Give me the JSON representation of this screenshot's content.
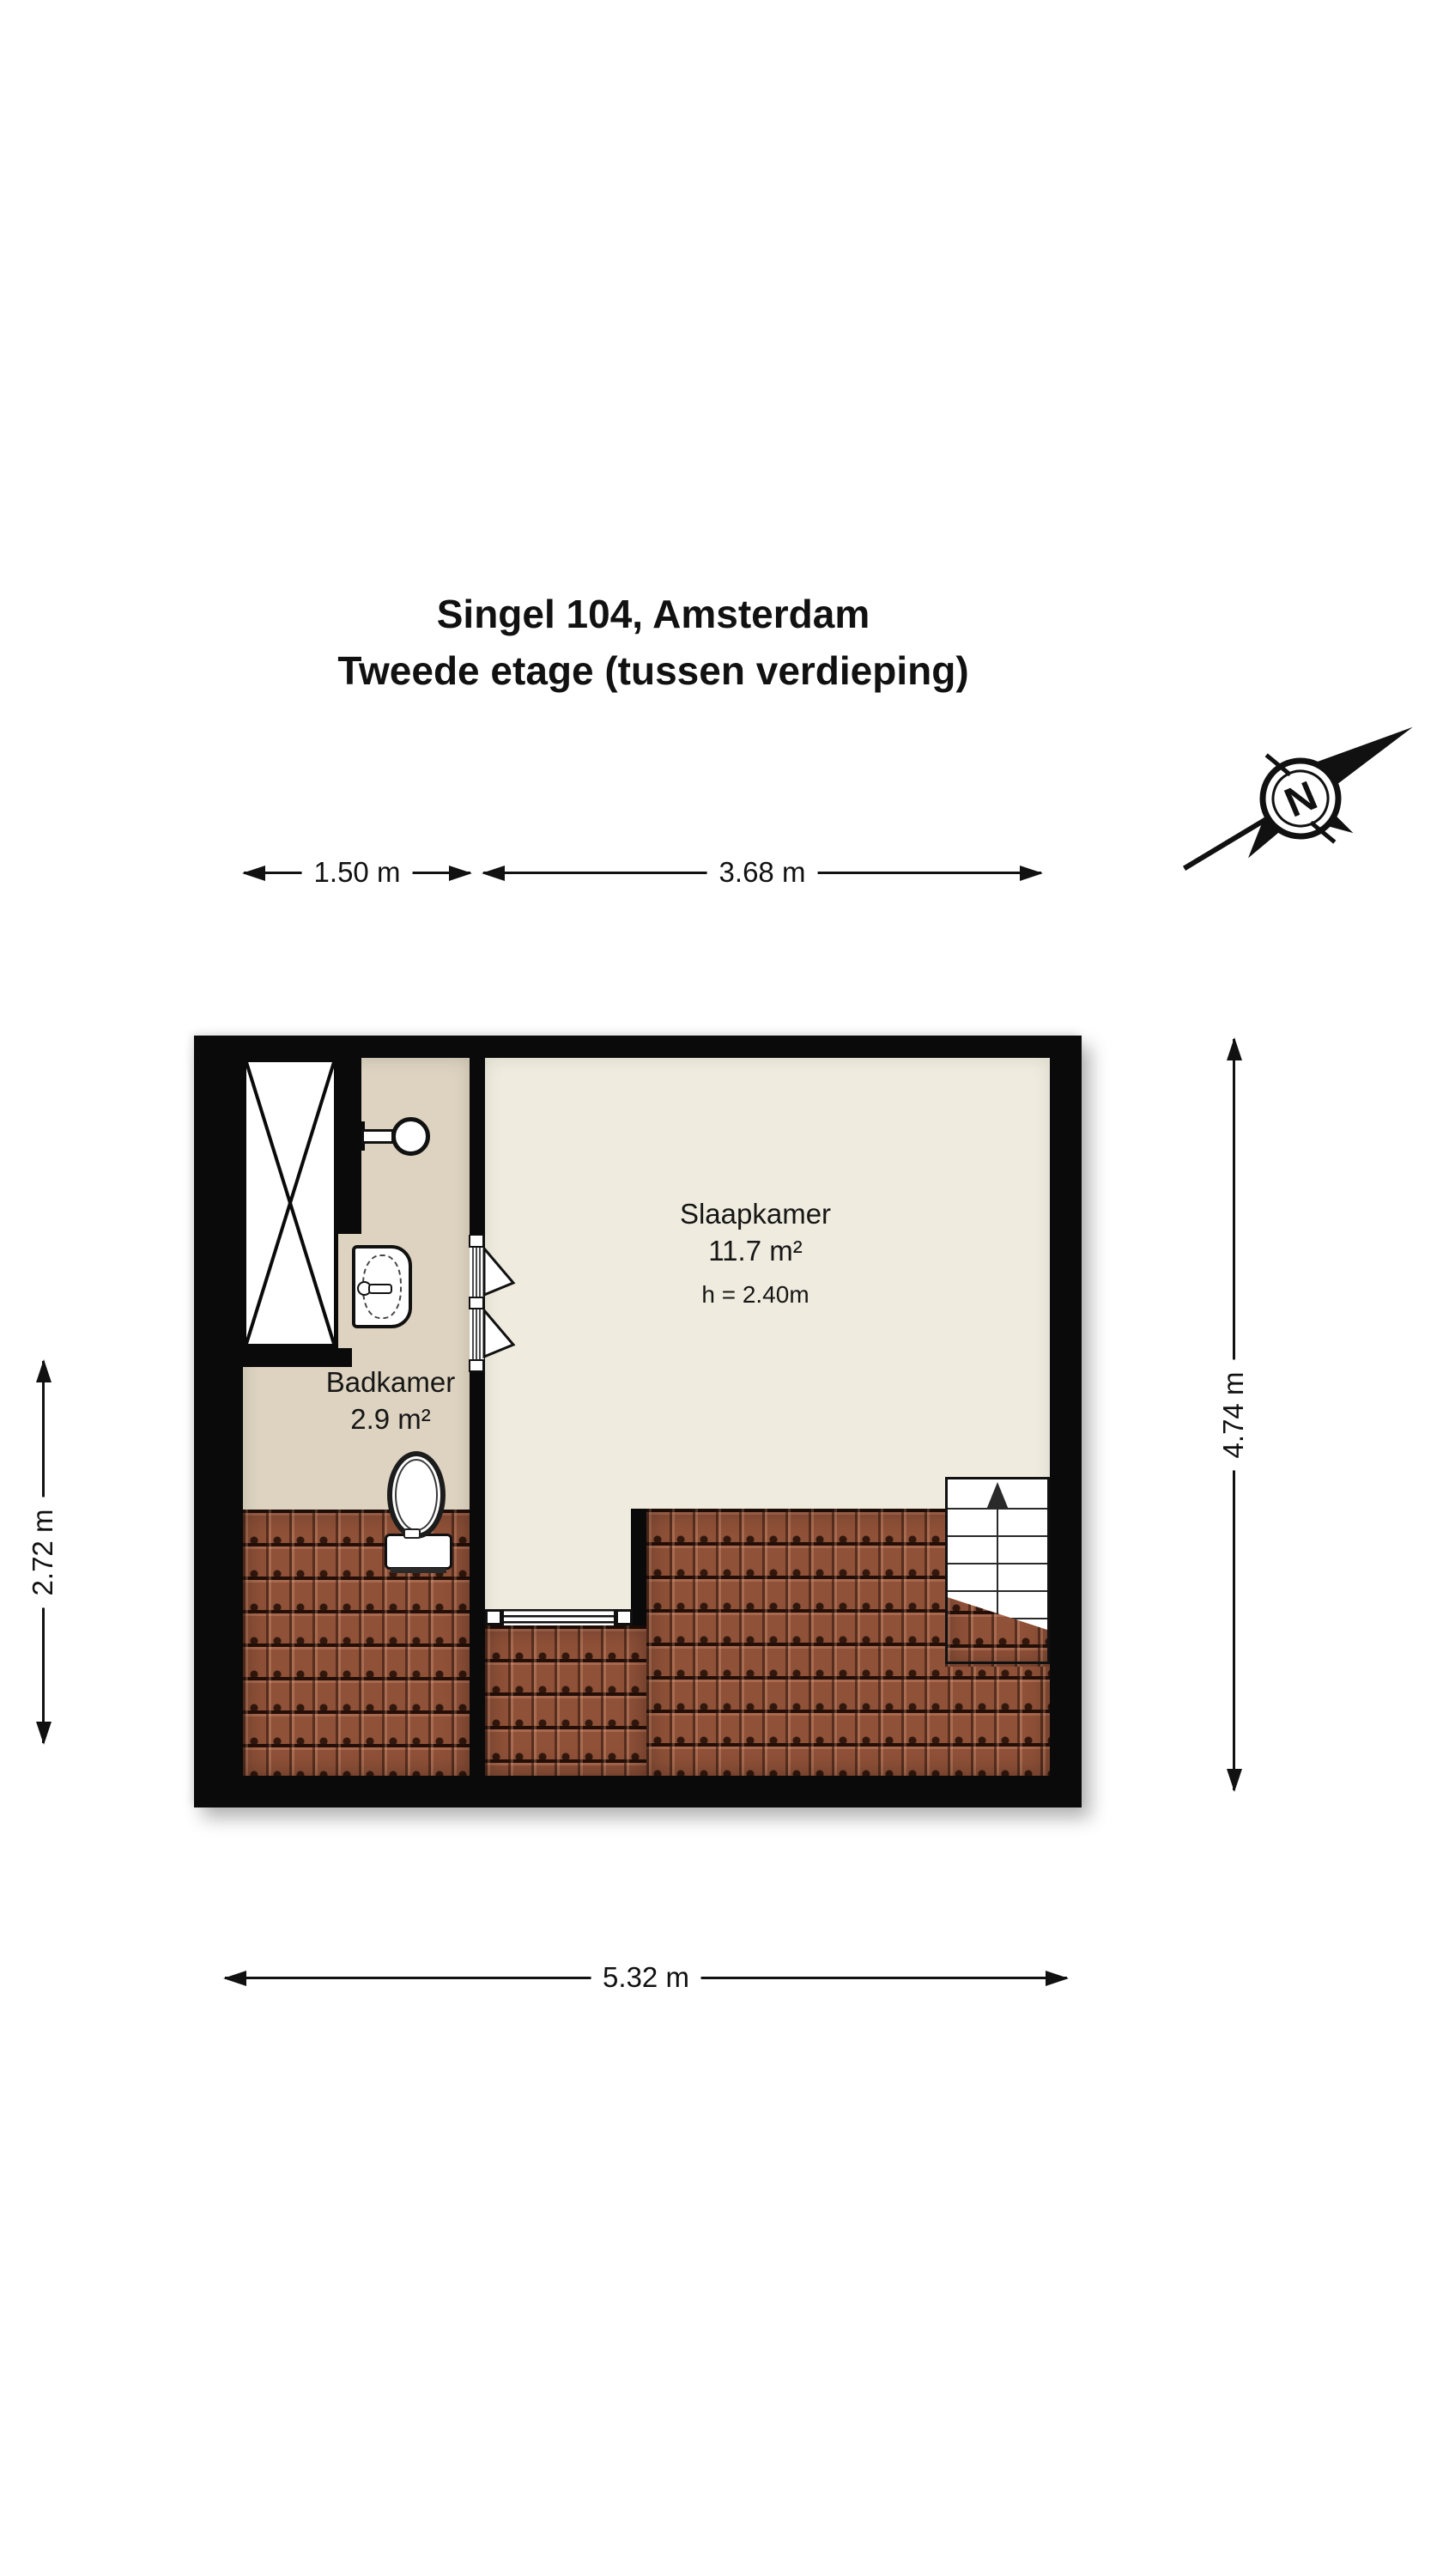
{
  "title": {
    "line1": "Singel 104, Amsterdam",
    "line2": "Tweede etage (tussen verdieping)"
  },
  "compass": {
    "letter": "N"
  },
  "dimensions": {
    "top_bathroom": "1.50 m",
    "top_bedroom": "3.68 m",
    "left_height": "2.72 m",
    "right_height": "4.74 m",
    "bottom_width": "5.32 m"
  },
  "rooms": {
    "badkamer": {
      "name": "Badkamer",
      "area": "2.9 m²"
    },
    "slaapkamer": {
      "name": "Slaapkamer",
      "area": "11.7 m²",
      "ceiling_height": "h = 2.40m"
    }
  },
  "icons": {
    "compass": "compass-rose-icon",
    "stairs_direction": "arrow-up-icon",
    "shower_marker": "x-cross-icon"
  },
  "colors": {
    "wall": "#0a0a0a",
    "bathroom_floor": "#ddd3c0",
    "bedroom_floor": "#efecdf",
    "roof_tiles": "#8f5138",
    "background": "#ffffff"
  }
}
